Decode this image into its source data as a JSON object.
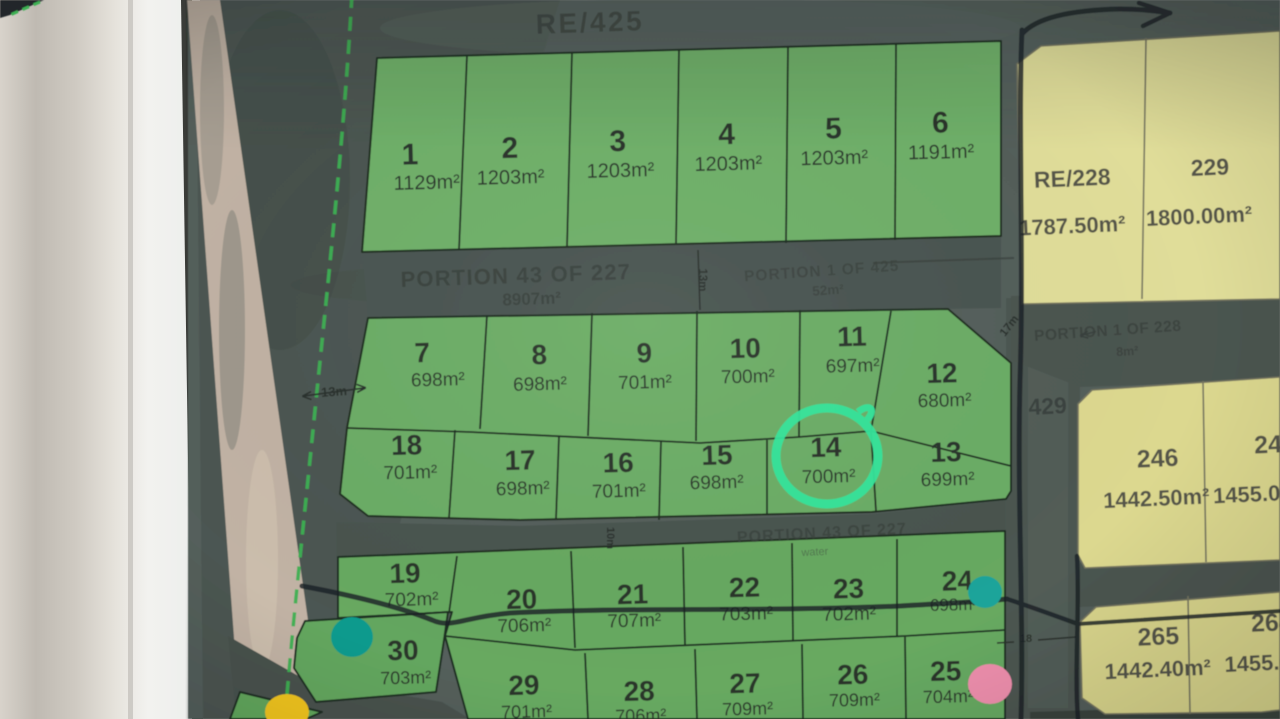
{
  "map": {
    "region_top_label": "RE/425",
    "road_number": "429",
    "portions": {
      "p43_top": {
        "name": "PORTION 43 OF 227",
        "area": "8907m²"
      },
      "p1_425": {
        "name": "PORTION 1 OF 425",
        "area": "52m²"
      },
      "p43_mid": {
        "name": "PORTION 43 OF 227",
        "note": "water"
      },
      "p1_228": {
        "name": "PORTION 1 OF 228",
        "area": "8m²"
      }
    },
    "dims": {
      "w13": "13m",
      "v13": "13m",
      "d17": "17m",
      "v10": "10m",
      "d18": "18"
    },
    "green_lots": [
      {
        "n": "1",
        "a": "1129m²"
      },
      {
        "n": "2",
        "a": "1203m²"
      },
      {
        "n": "3",
        "a": "1203m²"
      },
      {
        "n": "4",
        "a": "1203m²"
      },
      {
        "n": "5",
        "a": "1203m²"
      },
      {
        "n": "6",
        "a": "1191m²"
      },
      {
        "n": "7",
        "a": "698m²"
      },
      {
        "n": "8",
        "a": "698m²"
      },
      {
        "n": "9",
        "a": "701m²"
      },
      {
        "n": "10",
        "a": "700m²"
      },
      {
        "n": "11",
        "a": "697m²"
      },
      {
        "n": "12",
        "a": "680m²"
      },
      {
        "n": "13",
        "a": "699m²"
      },
      {
        "n": "14",
        "a": "700m²"
      },
      {
        "n": "15",
        "a": "698m²"
      },
      {
        "n": "16",
        "a": "701m²"
      },
      {
        "n": "17",
        "a": "698m²"
      },
      {
        "n": "18",
        "a": "701m²"
      },
      {
        "n": "19",
        "a": "702m²"
      },
      {
        "n": "20",
        "a": "706m²"
      },
      {
        "n": "21",
        "a": "707m²"
      },
      {
        "n": "22",
        "a": "703m²"
      },
      {
        "n": "23",
        "a": "702m²"
      },
      {
        "n": "24",
        "a": "698m²"
      },
      {
        "n": "25",
        "a": "704m²"
      },
      {
        "n": "26",
        "a": "709m²"
      },
      {
        "n": "27",
        "a": "709m²"
      },
      {
        "n": "28",
        "a": "706m²"
      },
      {
        "n": "29",
        "a": "701m²"
      },
      {
        "n": "30",
        "a": "703m²"
      }
    ],
    "yellow_lots": [
      {
        "n": "RE/228",
        "a": "1787.50m²"
      },
      {
        "n": "229",
        "a": "1800.00m²"
      },
      {
        "n": "246",
        "a": "1442.50m²"
      },
      {
        "n": "24",
        "a": "1455.00m²"
      },
      {
        "n": "265",
        "a": "1442.40m²"
      },
      {
        "n": "264",
        "a": "1455.00m²"
      }
    ],
    "highlight": {
      "circled_lot": "14",
      "circle_color": "#35e59b"
    },
    "markers": {
      "teal": "#109a8d",
      "teal2": "#1aa49a",
      "pink": "#ee8fad",
      "yellow": "#f0c41f",
      "boundary_green": "#3db052",
      "pen": "#1c2226"
    }
  }
}
